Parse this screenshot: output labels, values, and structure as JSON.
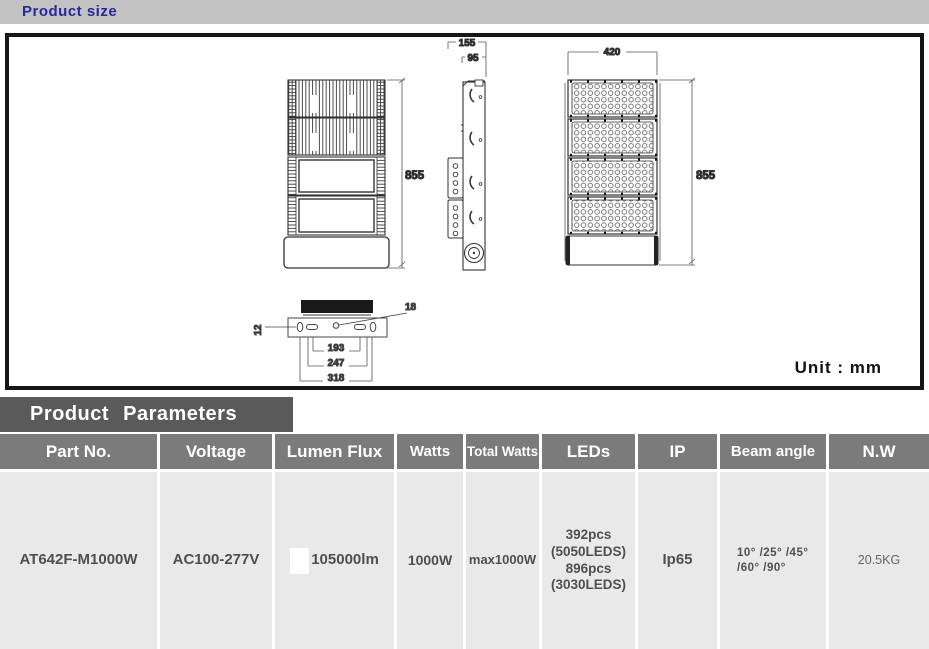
{
  "page": {
    "section_size_title": "Product size"
  },
  "drawing": {
    "unit_label": "Unit : mm",
    "dims": {
      "side_depth": "155",
      "side_inner_depth": "95",
      "front_width": "420",
      "back_height": "855",
      "front_height": "855",
      "bracket_plate": "12",
      "hole": "18",
      "mount_inner": "193",
      "mount_mid": "247",
      "mount_outer": "318"
    }
  },
  "parameters": {
    "section_title": "Product Parameters",
    "columns": [
      "Part No.",
      "Voltage",
      "Lumen Flux",
      "Watts",
      "Total Watts",
      "LEDs",
      "IP",
      "Beam angle",
      "N.W"
    ],
    "row": {
      "part_no": "AT642F-M1000W",
      "voltage": "AC100-277V",
      "lumen_flux": "105000lm",
      "watts": "1000W",
      "total_watts": "max1000W",
      "leds_lines": [
        "392pcs",
        "(5050LEDS)",
        "896pcs",
        "(3030LEDS)"
      ],
      "ip": "Ip65",
      "beam_angle_lines": [
        "10° /25° /45°",
        "/60° /90°"
      ],
      "nw": "20.5KG"
    }
  }
}
